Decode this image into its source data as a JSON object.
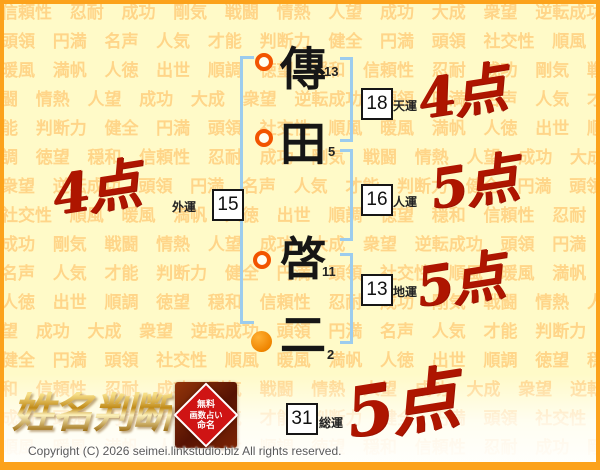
{
  "page": {
    "logo_text": "姓名判断",
    "copyright": "Copyright (C) 2026 seimei.linkstudio.biz All rights reserved."
  },
  "seal": {
    "lines": [
      "無料",
      "画数占い",
      "命名"
    ]
  },
  "name": {
    "characters": [
      {
        "char": "傳",
        "strokes": "13"
      },
      {
        "char": "田",
        "strokes": "5"
      },
      {
        "char": "啓",
        "strokes": "11"
      },
      {
        "char": "二",
        "strokes": "2"
      }
    ]
  },
  "fortunes": [
    {
      "value": "18",
      "label": "天運",
      "score": "4点"
    },
    {
      "value": "15",
      "label": "外運",
      "score": "4点"
    },
    {
      "value": "16",
      "label": "人運",
      "score": "5点"
    },
    {
      "value": "13",
      "label": "地運",
      "score": "5点"
    },
    {
      "value": "31",
      "label": "総運",
      "score": "5点"
    }
  ],
  "background_words": "信頼性 忍耐 成功 剛気 戦闘 情熱 人望 成功 大成 衆望 逆転成功 頭領 円満 名声 人気 才能 判断力 健全 円満 頭領 社交性 順風 暖風 満帆 人徳 出世 順調 徳望 穏和 ",
  "colors": {
    "border_orange": "#fca21b",
    "background_yellow": "#fffac8",
    "watermark_orange": "#ffc064",
    "bracket_blue": "#9cccee",
    "marker_ring": "#f25400",
    "marker_fill": "#f39000",
    "score_red": "#ae1500",
    "seal_red": "#cf1414"
  }
}
